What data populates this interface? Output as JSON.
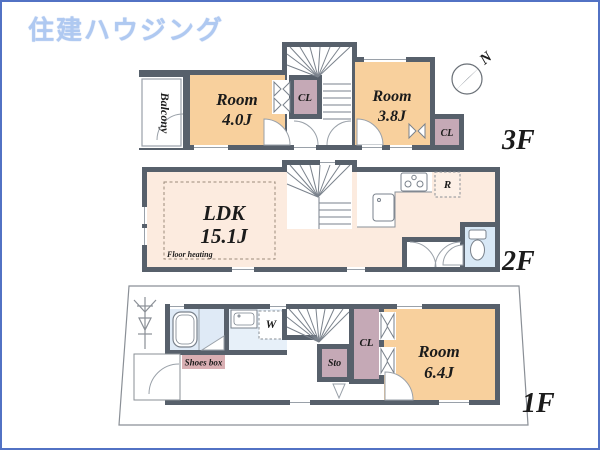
{
  "logo": {
    "text": "住建ハウジング"
  },
  "compass": {
    "north_label": "N"
  },
  "floors": {
    "f3": {
      "floor_label": "3F",
      "balcony_label": "Balcony",
      "room_a": {
        "name": "Room",
        "size": "4.0J"
      },
      "room_b": {
        "name": "Room",
        "size": "3.8J"
      },
      "closet_a": "CL",
      "closet_b": "CL"
    },
    "f2": {
      "floor_label": "2F",
      "ldk": {
        "name": "LDK",
        "size": "15.1J"
      },
      "floor_heating_label": "Floor heating",
      "fridge_label": "R"
    },
    "f1": {
      "floor_label": "1F",
      "room_c": {
        "name": "Room",
        "size": "6.4J"
      },
      "closet_c": "CL",
      "storage_label": "Sto",
      "washer_label": "W",
      "shoes_box_label": "Shoes box"
    }
  },
  "colors": {
    "wall": "#57606b",
    "room_orange": "#f8d09d",
    "ldk_peach": "#fcebdf",
    "closet_mauve": "#c5a9b6",
    "wet_blue": "#dfeaf6",
    "shoes_box_pink": "#d9afb3",
    "frame_border": "#5272c4",
    "logo_blue": "#afc9f1"
  }
}
